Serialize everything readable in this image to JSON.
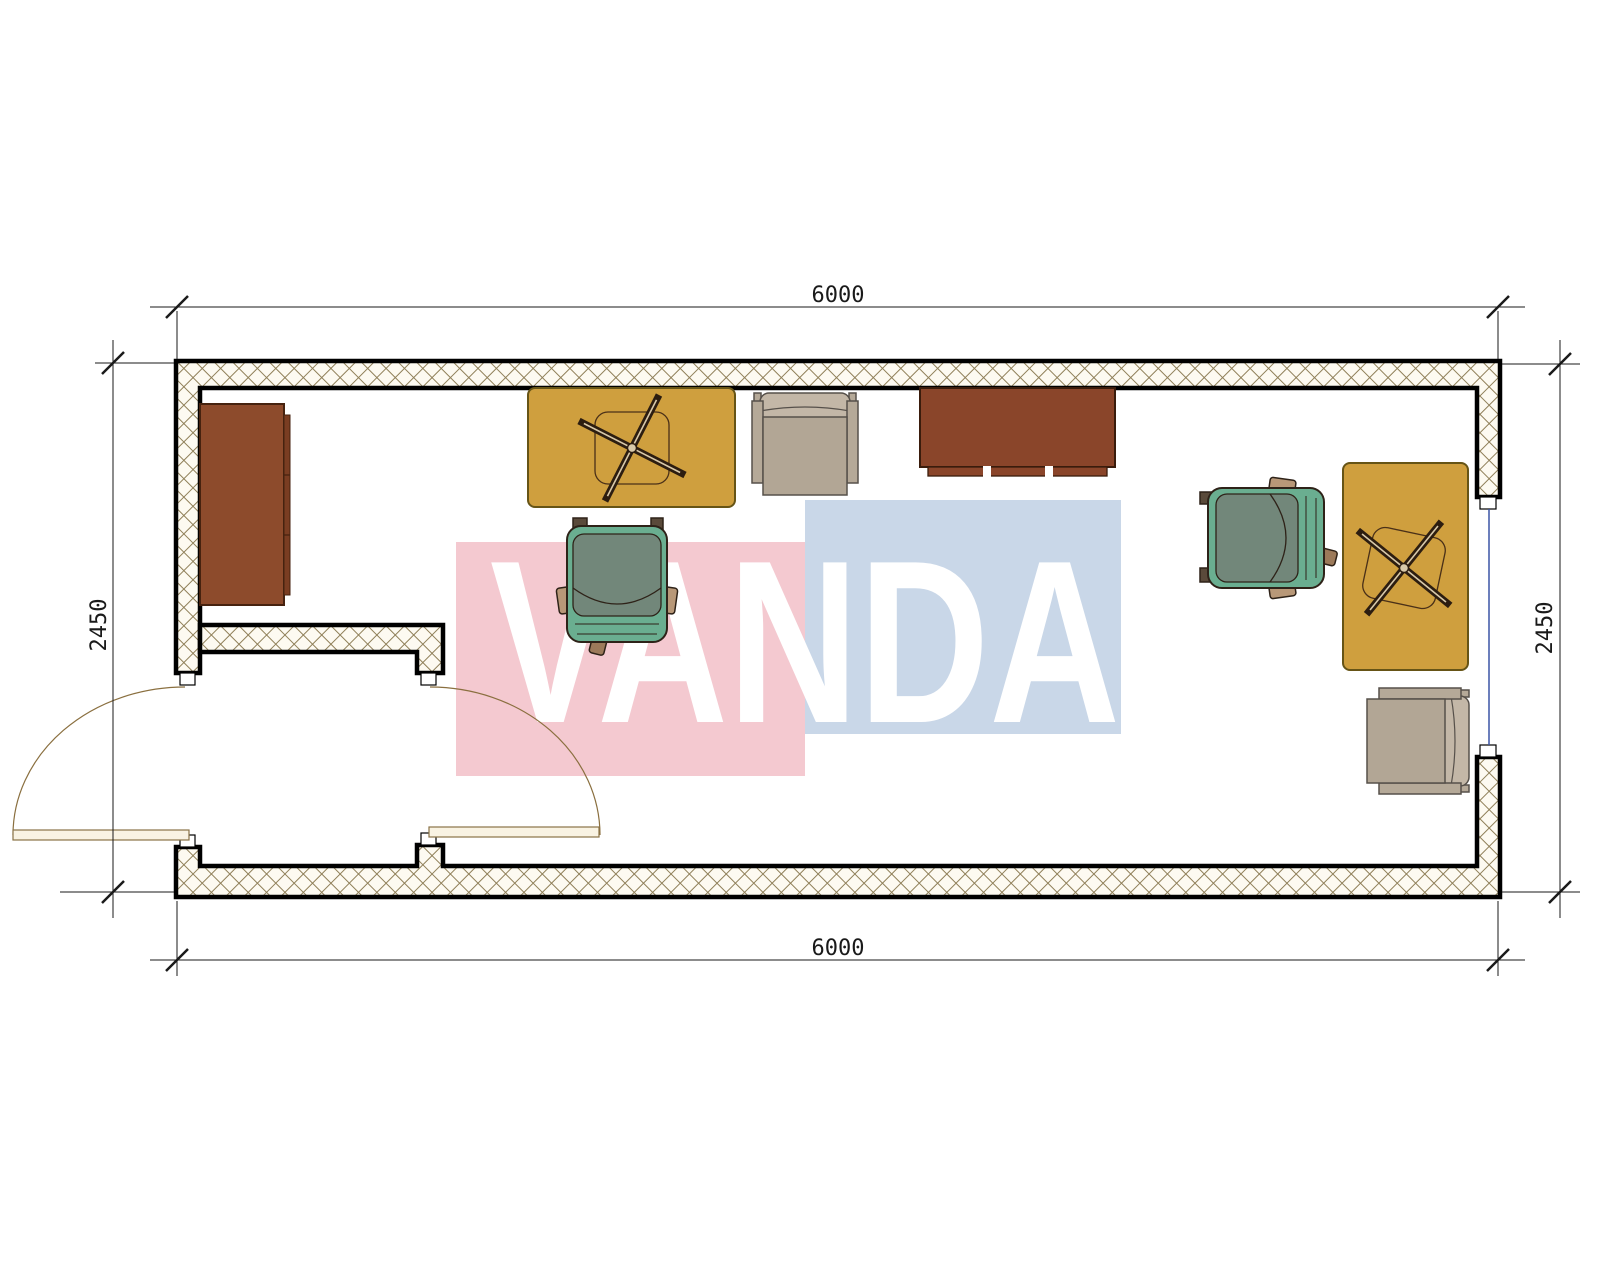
{
  "drawing": {
    "type": "floor-plan",
    "room": "single-room office container with entry vestibule, one exterior door, one interior door, one window"
  },
  "watermark": {
    "text": "VANDA",
    "pink": "#f4c9d0",
    "blue": "#c9d7e8",
    "text_color": "#ffffff"
  },
  "dimensions": {
    "width_top": "6000",
    "width_bottom": "6000",
    "height_left": "2450",
    "height_right": "2450"
  },
  "colors": {
    "wall_fill": "#fdfaf1",
    "hatch_line": "#8f7f58",
    "wall_outline": "#000000",
    "desk": "#cf9f3e",
    "desk_outline": "#665416",
    "cabinet": "#8d4b2c",
    "sideboard": "#8a452a",
    "wood_outline": "#46220f",
    "armchair": "#b5a998",
    "armchair_back": "#c3b7a7",
    "armchair_seat": "#b2a695",
    "armchair_outline": "#56504a",
    "office_chair": "#6aae90",
    "office_chair_seat": "#72877a",
    "office_chair_outline": "#2e2218",
    "caster": "#9c7a5a",
    "armrest": "#b89878",
    "chairbase": "#2c1d10",
    "window_glazing": "#3b55a5",
    "door_leaf": "#f9f3e3",
    "door_line": "#8a7347",
    "dimension_line": "#1a1a1a"
  },
  "furniture": [
    {
      "name": "storage-cabinet",
      "position": "left-wall"
    },
    {
      "name": "desk-with-chair-base",
      "position": "top-center"
    },
    {
      "name": "armchair",
      "position": "top-center-right"
    },
    {
      "name": "sideboard",
      "position": "top-right-center"
    },
    {
      "name": "office-chair",
      "position": "center"
    },
    {
      "name": "office-chair",
      "position": "right"
    },
    {
      "name": "desk-with-chair-base",
      "position": "right-wall"
    },
    {
      "name": "armchair",
      "position": "bottom-right"
    }
  ]
}
